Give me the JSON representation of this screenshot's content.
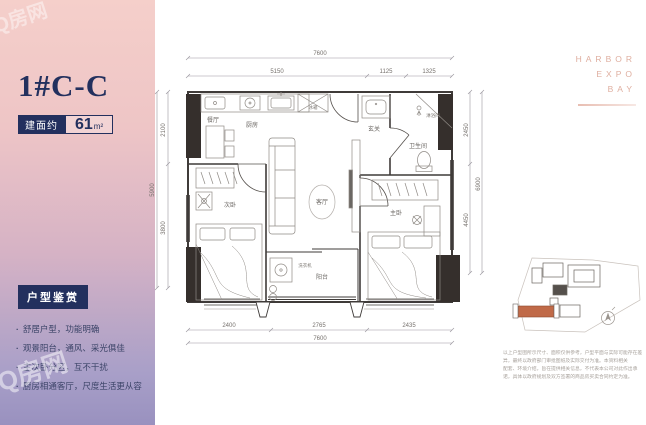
{
  "watermark": {
    "text": "Q房网"
  },
  "panel": {
    "unit_title": "1#C-C",
    "area_label": "建面约",
    "area_value": "61",
    "area_unit": "m²",
    "section_badge": "户型鉴赏",
    "features": [
      "舒居户型，功能明确",
      "观景阳台，通风、采光俱佳",
      "主次卧分区，互不干扰",
      "厨房相通客厅，尺度生活更从容"
    ]
  },
  "brand": {
    "line1": "HARBOR",
    "line2": "EXPO",
    "line3": "BAY"
  },
  "floor_plan": {
    "rooms": {
      "kitchen": "厨房",
      "dining": "餐厅",
      "living": "客厅",
      "bedroom_left": "次卧",
      "bedroom_right": "主卧",
      "bathroom": "卫生间",
      "shower": "淋浴间",
      "entry": "玄关",
      "balcony": "阳台",
      "washer": "洗衣机",
      "fridge": "冰箱"
    },
    "dimensions": {
      "top_total": "7600",
      "top_seg1": "5150",
      "top_seg2": "1125",
      "top_seg3": "1325",
      "bottom_seg1": "2400",
      "bottom_seg2": "2765",
      "bottom_seg3": "2435",
      "bottom_total": "7600",
      "left_seg1": "2100",
      "left_seg2": "3800",
      "left_total": "5900",
      "right_seg1": "2450",
      "right_seg2": "4450",
      "right_total": "6900"
    }
  },
  "site_plan": {
    "disclaimer_line1": "以上户型图所示尺寸、面积仅供参考，户型平面与实际可能存在差异，最终以政府部门审批图纸及实际交付为准。本资料相关",
    "disclaimer_line2": "配套、环境介绍，旨在提供相关信息，不代表本公司对此作出承诺，具体以政府规划及双方签署的商品房买卖合同约定为准。"
  },
  "colors": {
    "navy": "#23305e",
    "salmon": "#dfae9f",
    "highlight": "#c06a48",
    "gradient_top": "#f5cfca",
    "gradient_bottom": "#9991bf"
  }
}
